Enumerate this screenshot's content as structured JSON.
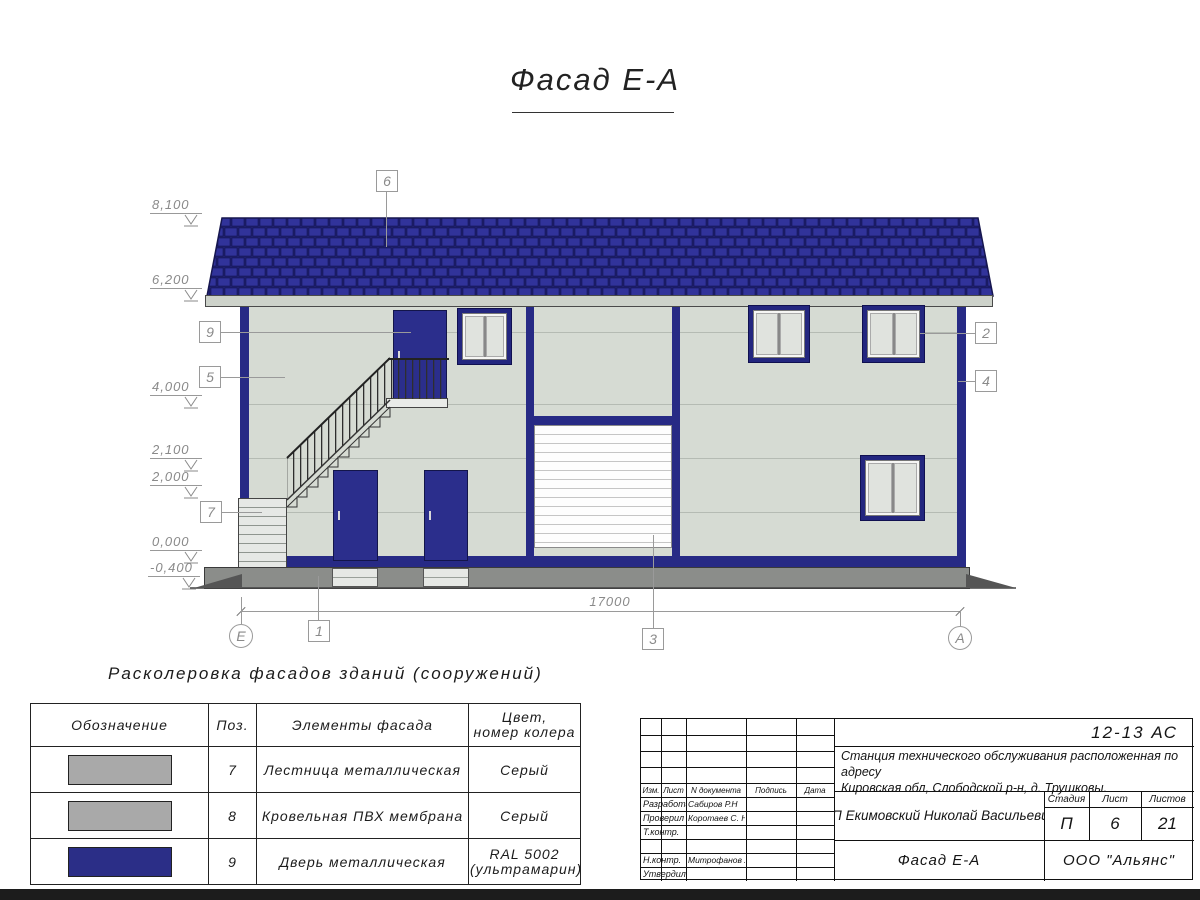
{
  "sheet": {
    "title": "Фасад Е-А"
  },
  "elevation_marks": [
    "8,100",
    "6,200",
    "4,000",
    "2,100",
    "2,000",
    "0,000",
    "-0,400"
  ],
  "callouts": [
    "6",
    "9",
    "5",
    "7",
    "2",
    "4",
    "1",
    "3"
  ],
  "axis_markers": {
    "left": "Е",
    "right": "А"
  },
  "dimensions": {
    "overall_width": "17000"
  },
  "legend": {
    "title": "Расколеровка фасадов зданий (сооружений)",
    "headers": {
      "designation": "Обозначение",
      "position": "Поз.",
      "element": "Элементы фасада",
      "color_line1": "Цвет,",
      "color_line2": "номер колера"
    },
    "rows": [
      {
        "pos": "7",
        "element": "Лестница металлическая",
        "color_line1": "Серый",
        "color_line2": "",
        "swatch": "#a9a9a9"
      },
      {
        "pos": "8",
        "element": "Кровельная ПВХ мембрана",
        "color_line1": "Серый",
        "color_line2": "",
        "swatch": "#a9a9a9"
      },
      {
        "pos": "9",
        "element": "Дверь металлическая",
        "color_line1": "RAL 5002",
        "color_line2": "(ультрамарин)",
        "swatch": "#2b2e87"
      }
    ]
  },
  "title_block": {
    "doc_number": "12-13 АС",
    "project_line1": "Станция технического обслуживания расположенная по адресу",
    "project_line2": "Кировская обл, Слободской р-н, д. Трушковы.",
    "header_cols": {
      "izm": "Изм.",
      "list": "Лист",
      "doc": "N документа",
      "sign": "Подпись",
      "date": "Дата"
    },
    "roles": [
      {
        "label": "Разработал",
        "name": "Сабиров Р.Н"
      },
      {
        "label": "Проверил",
        "name": "Коротаев С. Н."
      },
      {
        "label": "Т.контр.",
        "name": ""
      },
      {
        "label": "",
        "name": ""
      },
      {
        "label": "Н.контр.",
        "name": "Митрофанов Я. А."
      },
      {
        "label": "Утвердил",
        "name": ""
      }
    ],
    "client": "ИП Екимовский Николай Васильевич",
    "stage_header": {
      "stage": "Стадия",
      "sheet": "Лист",
      "sheets": "Листов"
    },
    "stage_values": {
      "stage": "П",
      "sheet": "6",
      "sheets": "21"
    },
    "drawing_name": "Фасад Е-А",
    "company": "ООО \"Альянс\""
  },
  "colors": {
    "roof_tile": "#31339a",
    "facade_wall": "#d6dbd3",
    "trim_ultramarine": "#272a85",
    "door_ultramarine": "#2b2e8c",
    "plinth_gray": "#8b8d8a",
    "swatch_gray": "#a9a9a9",
    "swatch_ultramarine": "#2b2e87"
  }
}
